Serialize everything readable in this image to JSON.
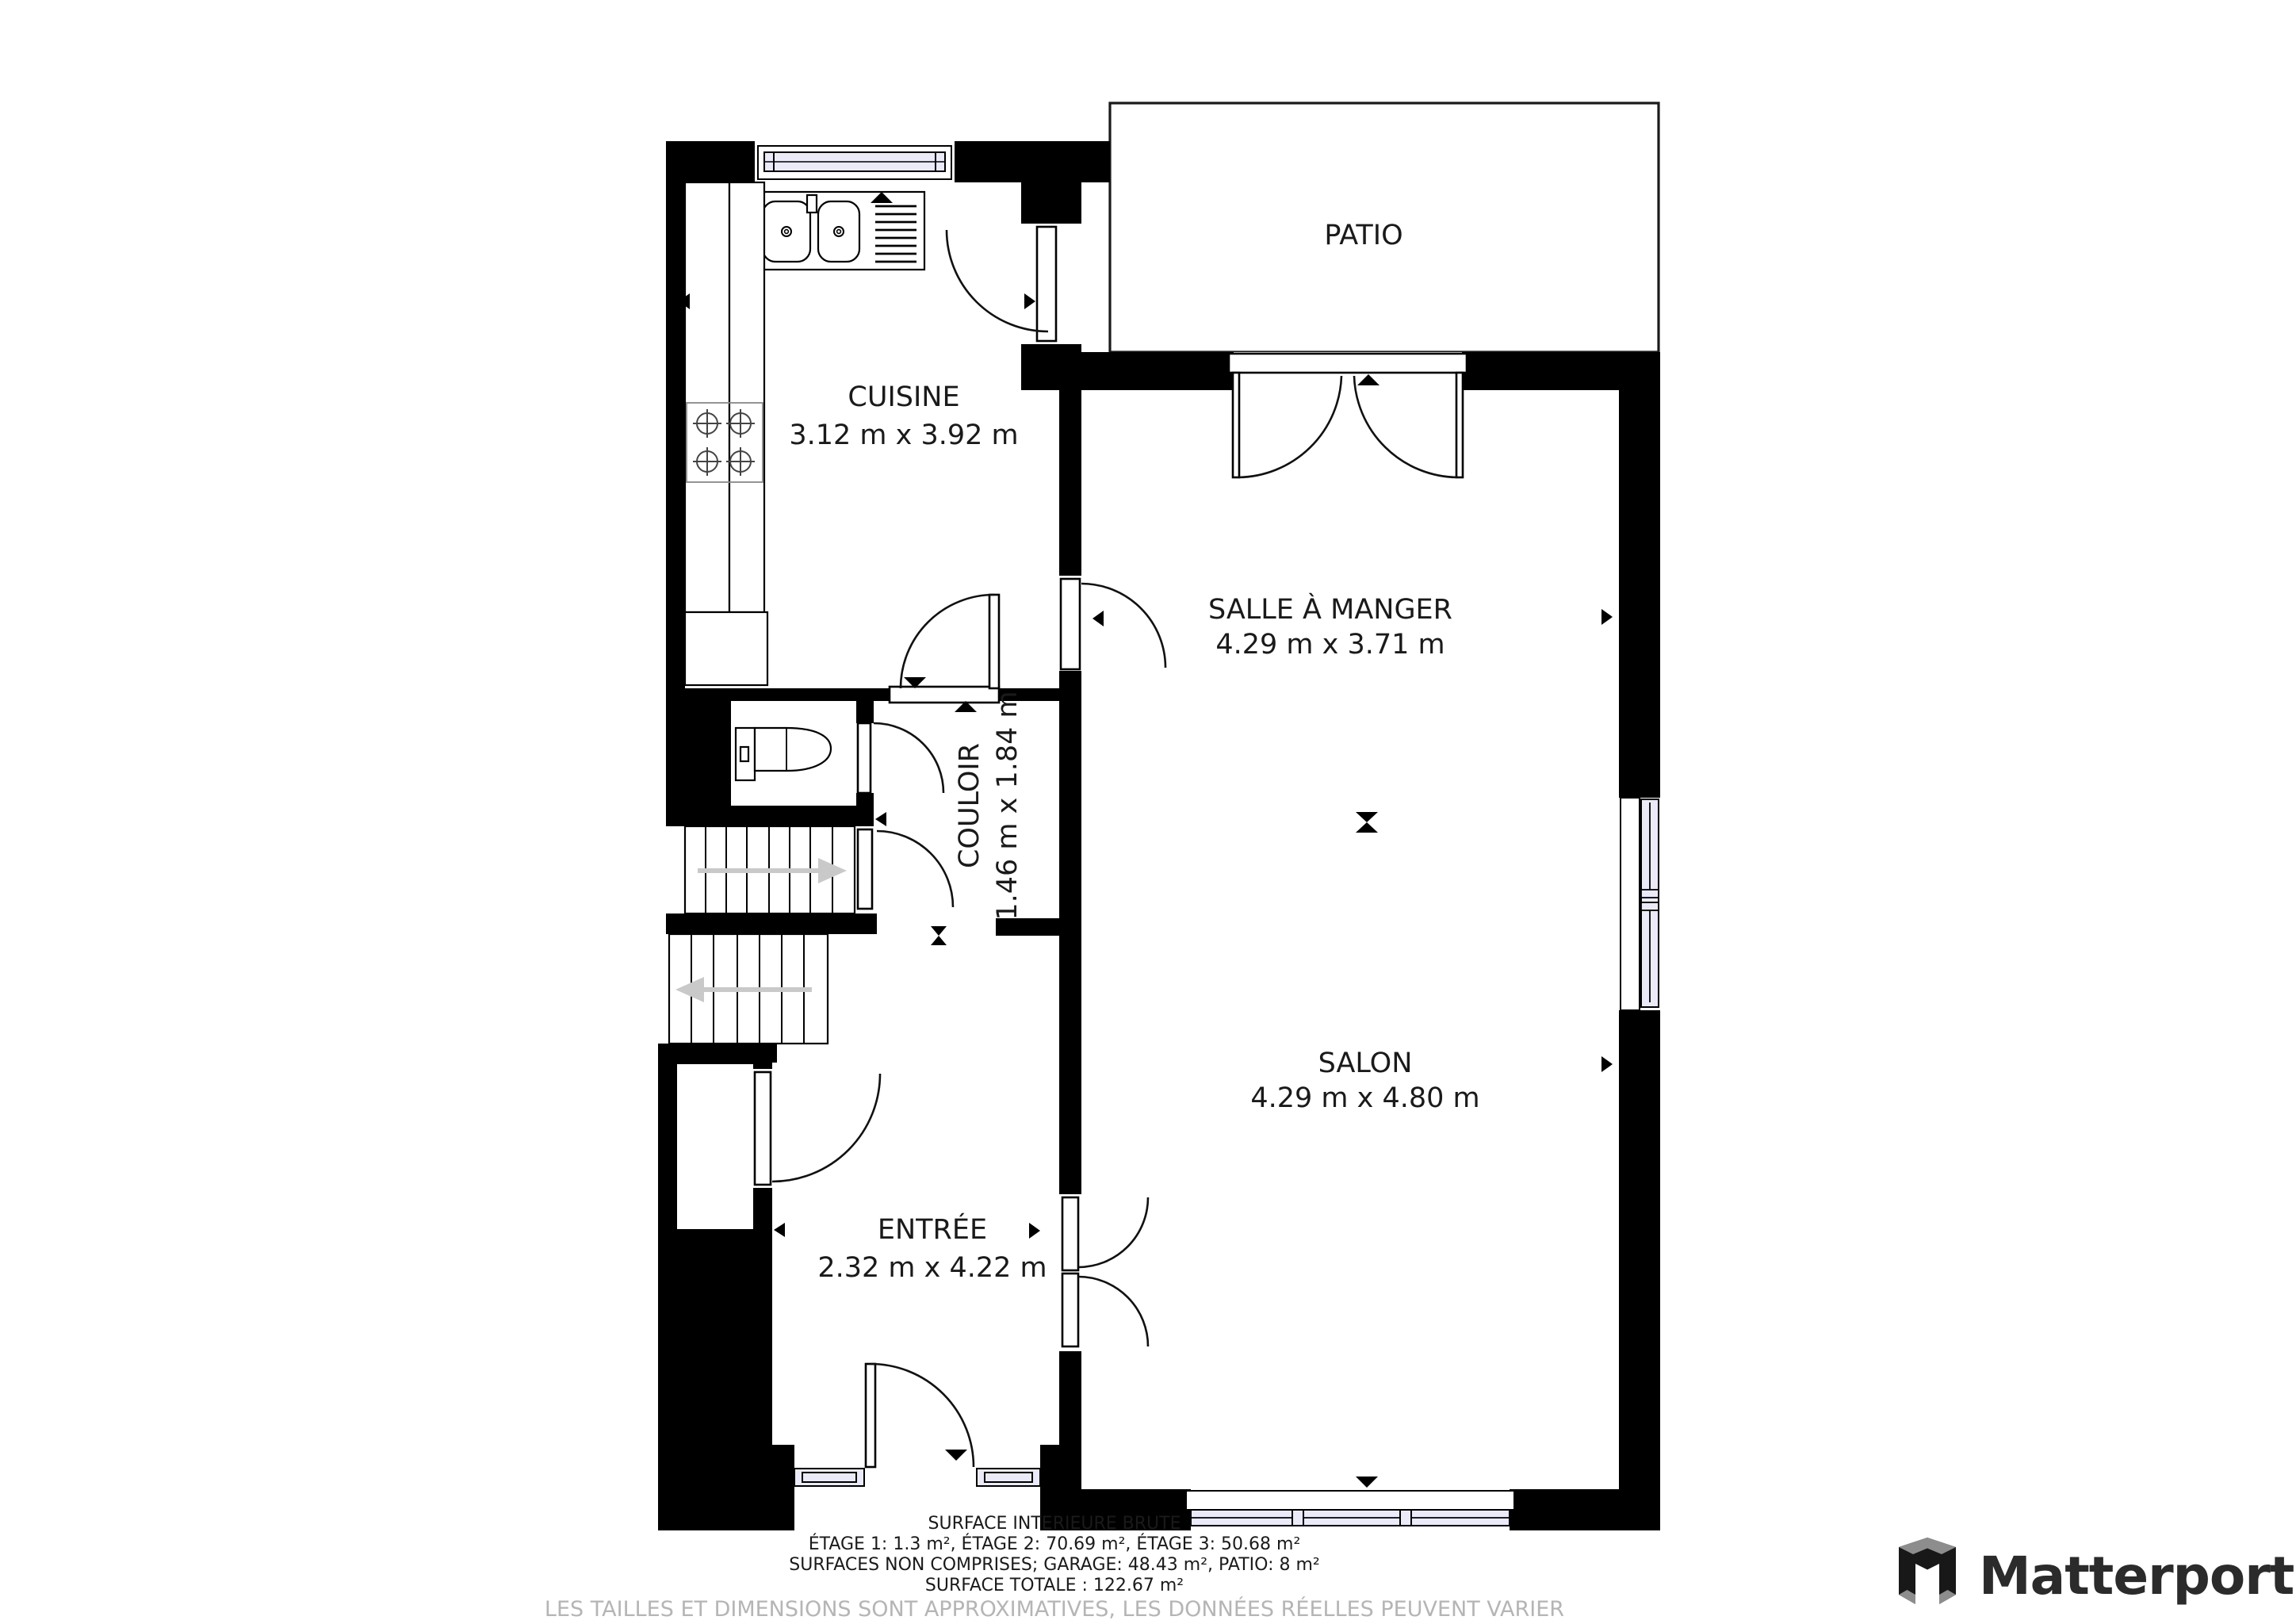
{
  "floor_plan": {
    "patio": {
      "label": "PATIO"
    },
    "rooms": [
      {
        "name": "CUISINE",
        "dims": "3.12 m x 3.92 m"
      },
      {
        "name": "SALLE À MANGER",
        "dims": "4.29 m x 3.71 m"
      },
      {
        "name": "COULOIR",
        "dims": "1.46 m x 1.84 m"
      },
      {
        "name": "SALON",
        "dims": "4.29 m x 4.80 m"
      },
      {
        "name": "ENTRÉE",
        "dims": "2.32 m x 4.22 m"
      }
    ],
    "icons": [
      "kitchen-sink-icon",
      "stove-burners-icon",
      "toilet-icon",
      "stairs-up-icon",
      "stairs-down-icon",
      "door-swing-icon",
      "window-icon"
    ]
  },
  "footer": {
    "title": "SURFACE INTERIEURE BRUTE",
    "line_etages": "ÉTAGE 1: 1.3 m², ÉTAGE 2: 70.69 m², ÉTAGE 3: 50.68 m²",
    "line_non_comprises": "SURFACES NON COMPRISES; GARAGE: 48.43 m², PATIO: 8 m²",
    "line_totale": "SURFACE TOTALE : 122.67 m²",
    "disclaimer": "LES TAILLES ET DIMENSIONS SONT APPROXIMATIVES, LES DONNÉES RÉELLES PEUVENT VARIER"
  },
  "brand": {
    "name": "Matterport"
  },
  "colors": {
    "wall": "#000000",
    "window_glass": "#eaeaf8",
    "stair_arrow": "#c9c9c9",
    "disclaimer_text": "#b5b5b5",
    "brand_text": "#2b2b2b"
  }
}
